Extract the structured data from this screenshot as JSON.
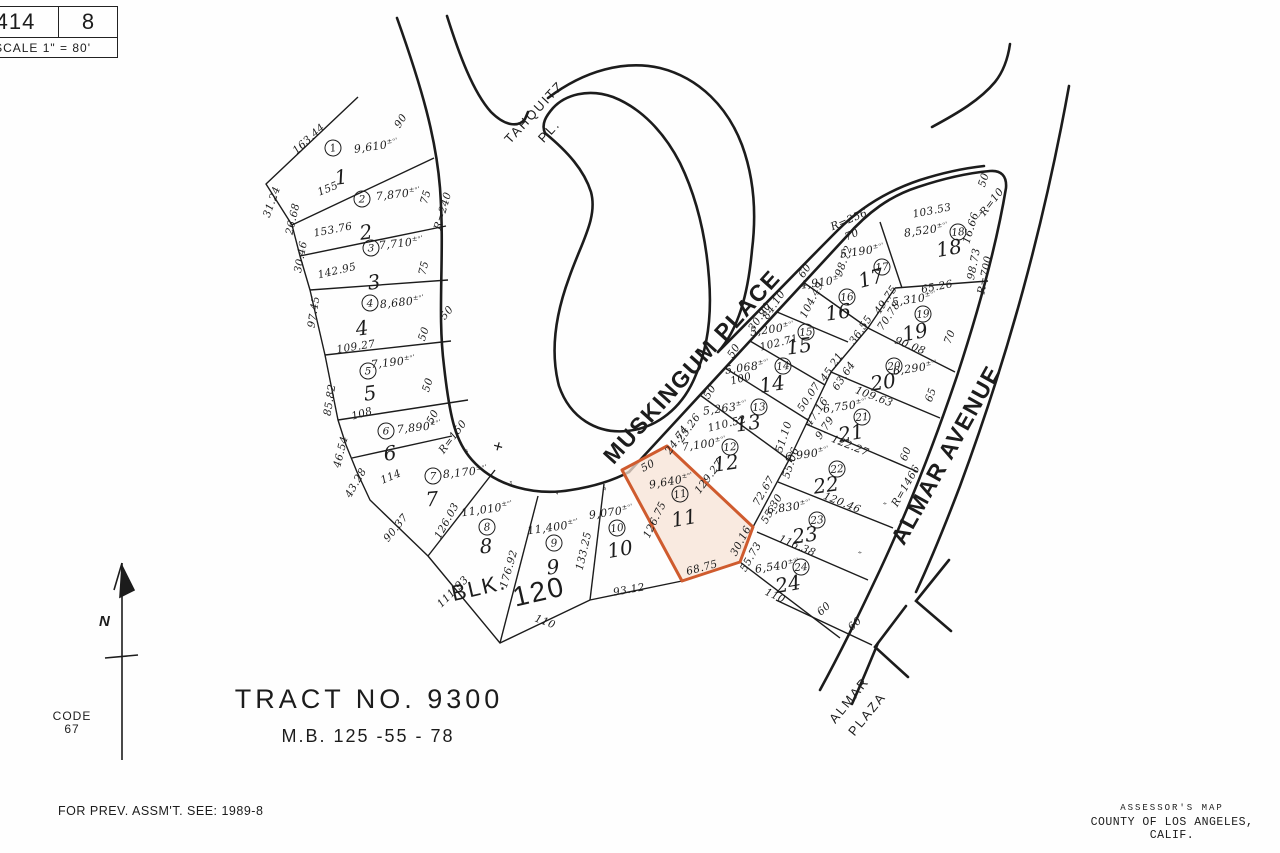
{
  "header": {
    "book": "414",
    "page": "8",
    "scale": "SCALE 1\" = 80'"
  },
  "title_block": {
    "tract": "TRACT  NO. 9300",
    "map_book": "M.B. 125 -55 - 78",
    "code_label": "CODE",
    "code_value": "67",
    "prev_assmt": "FOR PREV. ASSM'T. SEE: 1989-8",
    "assessor_line1": "ASSESSOR'S MAP",
    "assessor_line2": "COUNTY OF LOS ANGELES, CALIF.",
    "north_label": "N",
    "block_label": "BLK.",
    "block_number": "120"
  },
  "streets": [
    "TAHQUITZ PL.",
    "MUSKINGUM PLACE",
    "ALMAR AVENUE",
    "ALMAR PLAZA"
  ],
  "highlight": {
    "lot": "11",
    "fill": "#f7e3d6",
    "stroke": "#cf5b2e"
  },
  "meta": {
    "area_suffix": "±ᵒ'",
    "tick": "″",
    "cross": "+",
    "arrow": "→"
  },
  "parcels": [
    {
      "lot": "1",
      "area": "9,610"
    },
    {
      "lot": "2",
      "area": "7,870"
    },
    {
      "lot": "3",
      "area": "7,710"
    },
    {
      "lot": "4",
      "area": "8,680"
    },
    {
      "lot": "5",
      "area": "7,190"
    },
    {
      "lot": "6",
      "area": "7,890"
    },
    {
      "lot": "7",
      "area": "8,170"
    },
    {
      "lot": "8",
      "area": "11,010"
    },
    {
      "lot": "9",
      "area": "11,400"
    },
    {
      "lot": "10",
      "area": "9,070"
    },
    {
      "lot": "11",
      "area": "9,640"
    },
    {
      "lot": "12",
      "area": "7,100"
    },
    {
      "lot": "13",
      "area": "5,263"
    },
    {
      "lot": "14",
      "area": "5,068"
    },
    {
      "lot": "15",
      "area": "5,200"
    },
    {
      "lot": "16",
      "area": "4,910"
    },
    {
      "lot": "17",
      "area": "5,190"
    },
    {
      "lot": "18",
      "area": "8,520"
    },
    {
      "lot": "19",
      "area": "5,310"
    },
    {
      "lot": "20",
      "area": "6,290"
    },
    {
      "lot": "21",
      "area": "6,750"
    },
    {
      "lot": "22",
      "area": "6,990"
    },
    {
      "lot": "23",
      "area": "6,830"
    },
    {
      "lot": "24",
      "area": "6,540"
    }
  ],
  "map_labels": [
    {
      "t": "1",
      "x": 333,
      "y": 148,
      "r": -10,
      "k": "c"
    },
    {
      "t": "1",
      "x": 341,
      "y": 177,
      "r": -8,
      "k": "n"
    },
    {
      "t": "9,610",
      "x": 376,
      "y": 146,
      "r": -8,
      "k": "a"
    },
    {
      "t": "163.44",
      "x": 309,
      "y": 139,
      "r": -42,
      "k": "d"
    },
    {
      "t": "31.24",
      "x": 272,
      "y": 202,
      "r": -70,
      "k": "d"
    },
    {
      "t": "155",
      "x": 328,
      "y": 189,
      "r": -22,
      "k": "d"
    },
    {
      "t": "90",
      "x": 401,
      "y": 121,
      "r": -58,
      "k": "d"
    },
    {
      "t": "2",
      "x": 362,
      "y": 199,
      "r": 0,
      "k": "c"
    },
    {
      "t": "2",
      "x": 366,
      "y": 232,
      "r": -8,
      "k": "n"
    },
    {
      "t": "7,870",
      "x": 398,
      "y": 194,
      "r": -6,
      "k": "a"
    },
    {
      "t": "153.76",
      "x": 333,
      "y": 230,
      "r": -11,
      "k": "d"
    },
    {
      "t": "26.68",
      "x": 293,
      "y": 219,
      "r": -77,
      "k": "d"
    },
    {
      "t": "75",
      "x": 426,
      "y": 197,
      "r": -74,
      "k": "d"
    },
    {
      "t": "R=240",
      "x": 443,
      "y": 211,
      "r": -74,
      "k": "d"
    },
    {
      "t": "3",
      "x": 371,
      "y": 248,
      "r": 0,
      "k": "c"
    },
    {
      "t": "3",
      "x": 374,
      "y": 282,
      "r": -8,
      "k": "n"
    },
    {
      "t": "7,710",
      "x": 401,
      "y": 243,
      "r": -6,
      "k": "a"
    },
    {
      "t": "142.95",
      "x": 337,
      "y": 271,
      "r": -13,
      "k": "d"
    },
    {
      "t": "30.46",
      "x": 301,
      "y": 257,
      "r": -79,
      "k": "d"
    },
    {
      "t": "75",
      "x": 424,
      "y": 268,
      "r": -76,
      "k": "d"
    },
    {
      "t": "4",
      "x": 370,
      "y": 303,
      "r": 0,
      "k": "c"
    },
    {
      "t": "4",
      "x": 362,
      "y": 328,
      "r": -8,
      "k": "n"
    },
    {
      "t": "8,680",
      "x": 402,
      "y": 302,
      "r": -6,
      "k": "a"
    },
    {
      "t": "109.27",
      "x": 356,
      "y": 347,
      "r": -9,
      "k": "d"
    },
    {
      "t": "97.45",
      "x": 314,
      "y": 312,
      "r": -81,
      "k": "d"
    },
    {
      "t": "50",
      "x": 424,
      "y": 334,
      "r": -72,
      "k": "d"
    },
    {
      "t": "50",
      "x": 447,
      "y": 313,
      "r": -50,
      "k": "d"
    },
    {
      "t": "5",
      "x": 368,
      "y": 371,
      "r": 0,
      "k": "c"
    },
    {
      "t": "5",
      "x": 370,
      "y": 393,
      "r": -8,
      "k": "n"
    },
    {
      "t": "7,190",
      "x": 393,
      "y": 362,
      "r": -6,
      "k": "a"
    },
    {
      "t": "108",
      "x": 362,
      "y": 414,
      "r": -16,
      "k": "d"
    },
    {
      "t": "85.82",
      "x": 330,
      "y": 400,
      "r": -81,
      "k": "d"
    },
    {
      "t": "50",
      "x": 428,
      "y": 385,
      "r": -73,
      "k": "d"
    },
    {
      "t": "6",
      "x": 386,
      "y": 431,
      "r": 0,
      "k": "c"
    },
    {
      "t": "6",
      "x": 390,
      "y": 453,
      "r": -8,
      "k": "n"
    },
    {
      "t": "7,890",
      "x": 419,
      "y": 427,
      "r": -6,
      "k": "a"
    },
    {
      "t": "114",
      "x": 391,
      "y": 477,
      "r": -23,
      "k": "d"
    },
    {
      "t": "46.54",
      "x": 341,
      "y": 452,
      "r": -76,
      "k": "d"
    },
    {
      "t": "43.28",
      "x": 356,
      "y": 483,
      "r": -60,
      "k": "d"
    },
    {
      "t": "50",
      "x": 433,
      "y": 417,
      "r": -62,
      "k": "d"
    },
    {
      "t": "R=150",
      "x": 453,
      "y": 437,
      "r": -53,
      "k": "d"
    },
    {
      "t": "7",
      "x": 433,
      "y": 476,
      "r": 0,
      "k": "c"
    },
    {
      "t": "7",
      "x": 432,
      "y": 499,
      "r": -5,
      "k": "n"
    },
    {
      "t": "8,170",
      "x": 465,
      "y": 472,
      "r": -6,
      "k": "a"
    },
    {
      "t": "126.03",
      "x": 447,
      "y": 521,
      "r": -61,
      "k": "d"
    },
    {
      "t": "90.37",
      "x": 396,
      "y": 528,
      "r": -51,
      "k": "d"
    },
    {
      "t": "8",
      "x": 487,
      "y": 527,
      "r": -5,
      "k": "c"
    },
    {
      "t": "8",
      "x": 486,
      "y": 546,
      "r": -5,
      "k": "n"
    },
    {
      "t": "11,010",
      "x": 487,
      "y": 509,
      "r": -8,
      "k": "a"
    },
    {
      "t": "176.92",
      "x": 509,
      "y": 569,
      "r": -74,
      "k": "d"
    },
    {
      "t": "111.93",
      "x": 453,
      "y": 592,
      "r": -45,
      "k": "d"
    },
    {
      "t": "9",
      "x": 554,
      "y": 543,
      "r": -5,
      "k": "c"
    },
    {
      "t": "9",
      "x": 553,
      "y": 567,
      "r": -5,
      "k": "n"
    },
    {
      "t": "11,400",
      "x": 553,
      "y": 527,
      "r": -8,
      "k": "a"
    },
    {
      "t": "133.25",
      "x": 584,
      "y": 551,
      "r": -77,
      "k": "d"
    },
    {
      "t": "110",
      "x": 545,
      "y": 622,
      "r": 21,
      "k": "d"
    },
    {
      "t": "BLK.",
      "x": 479,
      "y": 588,
      "r": -13,
      "k": "b"
    },
    {
      "t": "120",
      "x": 539,
      "y": 592,
      "r": -13,
      "k": "b2"
    },
    {
      "t": "10",
      "x": 617,
      "y": 528,
      "r": -8,
      "k": "c"
    },
    {
      "t": "10",
      "x": 620,
      "y": 549,
      "r": -10,
      "k": "n"
    },
    {
      "t": "9,070",
      "x": 611,
      "y": 512,
      "r": -8,
      "k": "a"
    },
    {
      "t": "93.12",
      "x": 629,
      "y": 590,
      "r": -10,
      "k": "d"
    },
    {
      "t": "11",
      "x": 680,
      "y": 494,
      "r": -10,
      "k": "c"
    },
    {
      "t": "11",
      "x": 684,
      "y": 518,
      "r": -10,
      "k": "n"
    },
    {
      "t": "9,640",
      "x": 671,
      "y": 481,
      "r": -10,
      "k": "a"
    },
    {
      "t": "50",
      "x": 648,
      "y": 466,
      "r": -28,
      "k": "d"
    },
    {
      "t": "126.75",
      "x": 655,
      "y": 520,
      "r": -64,
      "k": "d"
    },
    {
      "t": "129.27",
      "x": 709,
      "y": 477,
      "r": -53,
      "k": "d"
    },
    {
      "t": "68.75",
      "x": 702,
      "y": 568,
      "r": -15,
      "k": "d"
    },
    {
      "t": "30.16",
      "x": 741,
      "y": 541,
      "r": -62,
      "k": "d"
    },
    {
      "t": "12",
      "x": 730,
      "y": 447,
      "r": -5,
      "k": "c"
    },
    {
      "t": "12",
      "x": 726,
      "y": 463,
      "r": -8,
      "k": "n"
    },
    {
      "t": "7,100",
      "x": 704,
      "y": 444,
      "r": -8,
      "k": "a"
    },
    {
      "t": "24.74",
      "x": 677,
      "y": 440,
      "r": -55,
      "k": "d"
    },
    {
      "t": "25.26",
      "x": 689,
      "y": 428,
      "r": -55,
      "k": "d"
    },
    {
      "t": "51.10",
      "x": 784,
      "y": 437,
      "r": -72,
      "k": "d"
    },
    {
      "t": "55.06",
      "x": 791,
      "y": 463,
      "r": -72,
      "k": "d"
    },
    {
      "t": "72.67",
      "x": 764,
      "y": 491,
      "r": -60,
      "k": "d"
    },
    {
      "t": "55.30",
      "x": 772,
      "y": 509,
      "r": -60,
      "k": "d"
    },
    {
      "t": "13",
      "x": 759,
      "y": 407,
      "r": -5,
      "k": "c"
    },
    {
      "t": "13",
      "x": 748,
      "y": 423,
      "r": -8,
      "k": "n"
    },
    {
      "t": "5,263",
      "x": 725,
      "y": 408,
      "r": -8,
      "k": "a"
    },
    {
      "t": "110.52",
      "x": 727,
      "y": 424,
      "r": -14,
      "k": "d"
    },
    {
      "t": "50",
      "x": 710,
      "y": 392,
      "r": -58,
      "k": "d"
    },
    {
      "t": "50.07",
      "x": 809,
      "y": 397,
      "r": -56,
      "k": "d"
    },
    {
      "t": "47.16",
      "x": 817,
      "y": 412,
      "r": -56,
      "k": "d"
    },
    {
      "t": "9.79",
      "x": 825,
      "y": 428,
      "r": -56,
      "k": "d"
    },
    {
      "t": "14",
      "x": 783,
      "y": 366,
      "r": -5,
      "k": "c"
    },
    {
      "t": "14",
      "x": 772,
      "y": 384,
      "r": -8,
      "k": "n"
    },
    {
      "t": "5,068",
      "x": 747,
      "y": 367,
      "r": -8,
      "k": "a"
    },
    {
      "t": "100",
      "x": 741,
      "y": 379,
      "r": -14,
      "k": "d"
    },
    {
      "t": "50",
      "x": 734,
      "y": 351,
      "r": -58,
      "k": "d"
    },
    {
      "t": "45.21",
      "x": 832,
      "y": 367,
      "r": -56,
      "k": "d"
    },
    {
      "t": "63.64",
      "x": 844,
      "y": 376,
      "r": -56,
      "k": "d"
    },
    {
      "t": "15",
      "x": 806,
      "y": 332,
      "r": -5,
      "k": "c"
    },
    {
      "t": "15",
      "x": 799,
      "y": 346,
      "r": -8,
      "k": "n"
    },
    {
      "t": "5,200",
      "x": 772,
      "y": 329,
      "r": -8,
      "k": "a"
    },
    {
      "t": "102.71",
      "x": 779,
      "y": 343,
      "r": -14,
      "k": "d"
    },
    {
      "t": "30.90",
      "x": 760,
      "y": 317,
      "r": -56,
      "k": "d"
    },
    {
      "t": "84.10",
      "x": 774,
      "y": 305,
      "r": -56,
      "k": "d"
    },
    {
      "t": "16",
      "x": 847,
      "y": 297,
      "r": -5,
      "k": "c"
    },
    {
      "t": "16",
      "x": 838,
      "y": 312,
      "r": -8,
      "k": "n"
    },
    {
      "t": "4,910",
      "x": 822,
      "y": 282,
      "r": -8,
      "k": "a"
    },
    {
      "t": "104.49",
      "x": 812,
      "y": 300,
      "r": -63,
      "k": "d"
    },
    {
      "t": "60",
      "x": 805,
      "y": 271,
      "r": -56,
      "k": "d"
    },
    {
      "t": "36.55",
      "x": 861,
      "y": 330,
      "r": -56,
      "k": "d"
    },
    {
      "t": "17",
      "x": 882,
      "y": 267,
      "r": -5,
      "k": "c"
    },
    {
      "t": "17",
      "x": 871,
      "y": 278,
      "r": -15,
      "k": "n"
    },
    {
      "t": "5,190",
      "x": 862,
      "y": 251,
      "r": -8,
      "k": "a"
    },
    {
      "t": "98.72",
      "x": 844,
      "y": 261,
      "r": -70,
      "k": "d"
    },
    {
      "t": "70",
      "x": 852,
      "y": 235,
      "r": -23,
      "k": "d"
    },
    {
      "t": "R=256",
      "x": 849,
      "y": 220,
      "r": -23,
      "k": "d"
    },
    {
      "t": "18",
      "x": 958,
      "y": 232,
      "r": -5,
      "k": "c"
    },
    {
      "t": "18",
      "x": 949,
      "y": 248,
      "r": -10,
      "k": "n"
    },
    {
      "t": "8,520",
      "x": 926,
      "y": 230,
      "r": -8,
      "k": "a"
    },
    {
      "t": "103.53",
      "x": 932,
      "y": 211,
      "r": -11,
      "k": "d"
    },
    {
      "t": "98.73",
      "x": 974,
      "y": 264,
      "r": -79,
      "k": "d"
    },
    {
      "t": "R=700",
      "x": 985,
      "y": 275,
      "r": -79,
      "k": "d"
    },
    {
      "t": "16.66",
      "x": 971,
      "y": 228,
      "r": -73,
      "k": "d"
    },
    {
      "t": "R=10",
      "x": 992,
      "y": 202,
      "r": -52,
      "k": "d"
    },
    {
      "t": "50",
      "x": 984,
      "y": 180,
      "r": -73,
      "k": "d"
    },
    {
      "x": 979,
      "y": 214,
      "r": -60,
      "k": "ar"
    },
    {
      "t": "19",
      "x": 923,
      "y": 314,
      "r": -5,
      "k": "c"
    },
    {
      "t": "19",
      "x": 915,
      "y": 332,
      "r": -12,
      "k": "n"
    },
    {
      "t": "5,310",
      "x": 914,
      "y": 299,
      "r": -8,
      "k": "a"
    },
    {
      "t": "65.26",
      "x": 937,
      "y": 287,
      "r": -11,
      "k": "d"
    },
    {
      "t": "90.08",
      "x": 910,
      "y": 346,
      "r": 21,
      "k": "d"
    },
    {
      "t": "70",
      "x": 950,
      "y": 337,
      "r": -70,
      "k": "d"
    },
    {
      "t": "49.75",
      "x": 886,
      "y": 300,
      "r": -56,
      "k": "d"
    },
    {
      "t": "70.78",
      "x": 889,
      "y": 316,
      "r": -56,
      "k": "d"
    },
    {
      "t": "20",
      "x": 894,
      "y": 366,
      "r": -5,
      "k": "c"
    },
    {
      "t": "20",
      "x": 883,
      "y": 382,
      "r": -8,
      "k": "n"
    },
    {
      "t": "6,290",
      "x": 915,
      "y": 368,
      "r": -8,
      "k": "a"
    },
    {
      "t": "109.63",
      "x": 874,
      "y": 397,
      "r": 21,
      "k": "d"
    },
    {
      "t": "65",
      "x": 931,
      "y": 395,
      "r": -70,
      "k": "d"
    },
    {
      "t": "21",
      "x": 862,
      "y": 417,
      "r": -5,
      "k": "c"
    },
    {
      "t": "21",
      "x": 851,
      "y": 433,
      "r": -10,
      "k": "n"
    },
    {
      "t": "6,750",
      "x": 845,
      "y": 406,
      "r": -8,
      "k": "a"
    },
    {
      "t": "122.27",
      "x": 850,
      "y": 446,
      "r": 22,
      "k": "d"
    },
    {
      "t": "22",
      "x": 837,
      "y": 469,
      "r": -5,
      "k": "c"
    },
    {
      "t": "22",
      "x": 826,
      "y": 485,
      "r": -8,
      "k": "n"
    },
    {
      "t": "6,990",
      "x": 807,
      "y": 454,
      "r": -8,
      "k": "a"
    },
    {
      "t": "120.46",
      "x": 842,
      "y": 503,
      "r": 22,
      "k": "d"
    },
    {
      "t": "60",
      "x": 906,
      "y": 454,
      "r": -70,
      "k": "d"
    },
    {
      "t": "R=1466",
      "x": 906,
      "y": 486,
      "r": -60,
      "k": "d"
    },
    {
      "t": "23",
      "x": 817,
      "y": 520,
      "r": -5,
      "k": "c"
    },
    {
      "t": "23",
      "x": 805,
      "y": 535,
      "r": -8,
      "k": "n"
    },
    {
      "t": "6,830",
      "x": 789,
      "y": 507,
      "r": -8,
      "k": "a"
    },
    {
      "t": "116.38",
      "x": 797,
      "y": 546,
      "r": 23,
      "k": "d"
    },
    {
      "t": "24",
      "x": 801,
      "y": 567,
      "r": -5,
      "k": "c"
    },
    {
      "t": "24",
      "x": 788,
      "y": 584,
      "r": -10,
      "k": "n"
    },
    {
      "t": "6,540",
      "x": 777,
      "y": 566,
      "r": -8,
      "k": "a"
    },
    {
      "t": "110",
      "x": 775,
      "y": 596,
      "r": 24,
      "k": "d"
    },
    {
      "t": "55.73",
      "x": 751,
      "y": 557,
      "r": -60,
      "k": "d"
    },
    {
      "t": "60",
      "x": 824,
      "y": 609,
      "r": -42,
      "k": "d"
    },
    {
      "t": "60",
      "x": 855,
      "y": 624,
      "r": -42,
      "k": "d"
    },
    {
      "x": 463,
      "y": 452,
      "r": 70,
      "k": "t"
    },
    {
      "x": 507,
      "y": 483,
      "r": 80,
      "k": "t"
    },
    {
      "x": 553,
      "y": 493,
      "r": 90,
      "k": "t"
    },
    {
      "x": 601,
      "y": 488,
      "r": 100,
      "k": "t"
    },
    {
      "x": 675,
      "y": 440,
      "r": 45,
      "k": "t"
    },
    {
      "x": 883,
      "y": 507,
      "r": 30,
      "k": "t"
    },
    {
      "x": 858,
      "y": 556,
      "r": 30,
      "k": "t"
    },
    {
      "x": 498,
      "y": 447,
      "r": 15,
      "k": "x"
    },
    {
      "t": "TAHQUITZ",
      "x": 534,
      "y": 112,
      "r": -47,
      "k": "s1"
    },
    {
      "t": "PL.",
      "x": 549,
      "y": 131,
      "r": -47,
      "k": "s1"
    },
    {
      "t": "MUSKINGUM PLACE",
      "x": 692,
      "y": 367,
      "r": -48,
      "k": "s2"
    },
    {
      "t": "ALMAR AVENUE",
      "x": 946,
      "y": 455,
      "r": -61,
      "k": "s2"
    },
    {
      "t": "ALMAR",
      "x": 849,
      "y": 700,
      "r": -51,
      "k": "s1"
    },
    {
      "t": "PLAZA",
      "x": 867,
      "y": 714,
      "r": -51,
      "k": "s1"
    }
  ]
}
